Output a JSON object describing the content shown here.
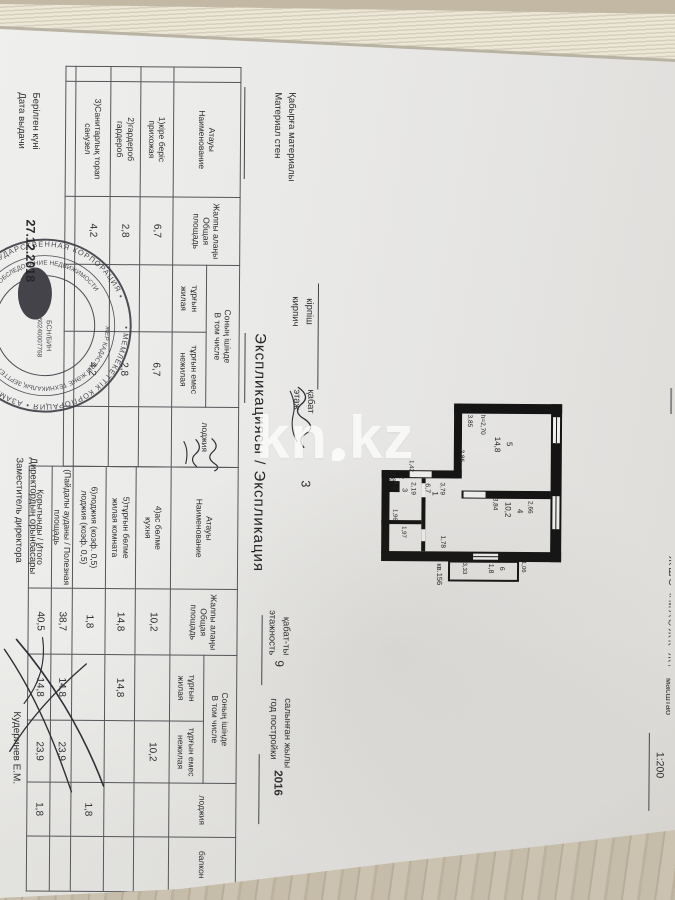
{
  "photo": {
    "watermark_left": "kn",
    "watermark_right": "kz"
  },
  "header": {
    "top_fragment": "ЖШС «МАӘЖК-ЖМ БД»",
    "scale_label": "масштаб",
    "scale_value": "1:200",
    "wall_kk": "Қабырға материалы",
    "wall_ru": "Материал стен",
    "wall_value_kk": "кірпіш",
    "wall_value_ru": "кирпич",
    "floor_kk": "қабат",
    "floor_ru": "этаж",
    "floor_value": "3",
    "floors_kk": "қабат-ты",
    "floors_ru": "этажность",
    "floors_value": "9",
    "built_kk": "салынған жылы",
    "built_ru": "год постройки",
    "built_value": "2016"
  },
  "title": {
    "kk": "Экспликациясы",
    "sep": "/",
    "ru": "Экспликация"
  },
  "table_headers": {
    "name_kk": "Атауы",
    "name_ru": "Наименование",
    "total_kk": "Жалпы алаңы",
    "total_ru": "Общая площадь",
    "incl_kk": "Соның ішінде",
    "incl_ru": "В том числе",
    "living_kk": "тұрғын",
    "living_ru": "жилая",
    "nonliving_kk": "тұрғын емес",
    "nonliving_ru": "нежилая",
    "loggia": "лоджия",
    "balcony": "балкон"
  },
  "table1": {
    "rows": [
      {
        "name_kk": "1)кіре беріс",
        "name_ru": "прихожая",
        "total": "6,7",
        "living": "",
        "nonliving": "6,7",
        "loggia": ""
      },
      {
        "name_kk": "2)гардероб",
        "name_ru": "гардероб",
        "total": "2,8",
        "living": "",
        "nonliving": "2,8",
        "loggia": ""
      },
      {
        "name_kk": "3)Санитарлық торап",
        "name_ru": "санузел",
        "total": "4,2",
        "living": "",
        "nonliving": "4,2",
        "loggia": ""
      }
    ]
  },
  "table2": {
    "rows": [
      {
        "name_kk": "4)ас бөлме",
        "name_ru": "кухня",
        "total": "10,2",
        "living": "",
        "nonliving": "10,2",
        "loggia": "",
        "balcony": ""
      },
      {
        "name_kk": "5)тұрғын бөлме",
        "name_ru": "жилая комната",
        "total": "14,8",
        "living": "14,8",
        "nonliving": "",
        "loggia": "",
        "balcony": ""
      },
      {
        "name_kk": "6)лоджия (коэф. 0,5)",
        "name_ru": "лоджия (коэф. 0,5)",
        "total": "1,8",
        "living": "",
        "nonliving": "",
        "loggia": "1,8",
        "balcony": ""
      },
      {
        "name_kk": "(Пайдалы ауданы",
        "name_ru": "Полезная площадь",
        "total": "38,7",
        "living": "14,8",
        "nonliving": "23,9",
        "loggia": "",
        "balcony": ""
      },
      {
        "name_kk": "Қорытынды",
        "name_ru": "Итого",
        "total": "40,5",
        "living": "14,8",
        "nonliving": "23,9",
        "loggia": "1,8",
        "balcony": ""
      }
    ]
  },
  "plan": {
    "apartment": "кв.156",
    "height_note": "h=2,70",
    "room5": {
      "num": "5",
      "area": "14,8",
      "dim1": "3,85",
      "dim2": "3,85"
    },
    "room4": {
      "num": "4",
      "area": "10,2",
      "dim_w": "3,84",
      "dim_h": "2,66"
    },
    "room6": {
      "num": "6",
      "area": "1,8",
      "dim_w": "1,06",
      "dim_h": "3,33"
    },
    "room1": {
      "num": "1",
      "area": "6,7",
      "dim": "3,79",
      "door": "1,78"
    },
    "room3": {
      "num": "3",
      "area": "4,2",
      "dim": "2,19"
    },
    "room2": {
      "num": "2",
      "area": "2,8",
      "dim1": "1,97",
      "dim2": "1,42",
      "dim3": "1,96"
    }
  },
  "stamp": {
    "ring_outer": "• МЕМЛЕКЕТТІК КОРПОРАЦИЯ • АЗАМАТТАРҒА АРНАЛҒАН ҮКІМЕТ • ГОСУДАРСТВЕННАЯ КОРПОРАЦИЯ •",
    "ring_inner": "ЖЕР КАДАСТРЫ ЖӘНЕ ТЕХНИКАЛЫҚ ЗЕРТТЕУ • КАДАСТР И ТЕХНИЧЕСКОЕ ОБСЛЕДОВАНИЕ НЕДВИЖИМОСТИ",
    "bin_label": "БСН/БИН",
    "bin_value": "160240007768"
  },
  "footer": {
    "issued_kk": "Берілген күні",
    "issued_ru": "Дата выдачи",
    "date": "27.12.2018",
    "deputy_kk": "Директордың орынбасары",
    "deputy_ru": "Заместитель директора",
    "signer": "Кудеринев Е.М."
  }
}
